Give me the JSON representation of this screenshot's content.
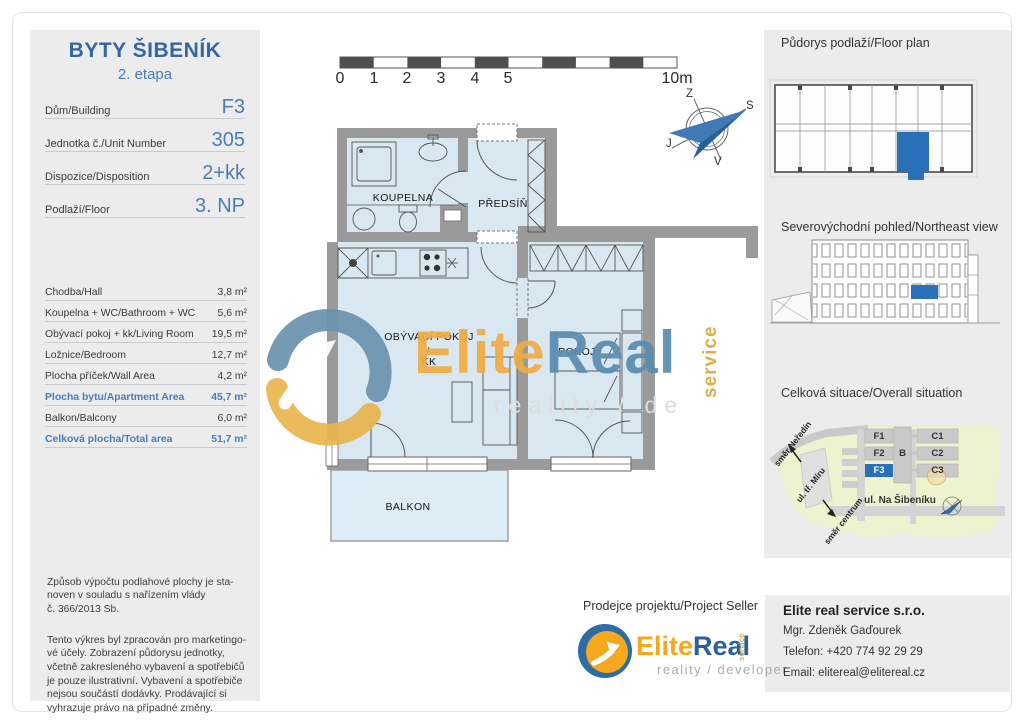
{
  "page": {
    "title": "BYTY ŠIBENÍK",
    "subtitle": "2. etapa"
  },
  "unit_fields": [
    {
      "label": "Dům/Building",
      "value": "F3"
    },
    {
      "label": "Jednotka č./Unit Number",
      "value": "305"
    },
    {
      "label": "Dispozice/Disposition",
      "value": "2+kk"
    },
    {
      "label": "Podlaží/Floor",
      "value": "3. NP"
    }
  ],
  "areas": [
    {
      "label": "Chodba/Hall",
      "value": "3,8 m²"
    },
    {
      "label": "Koupelna + WC/Bathroom + WC",
      "value": "5,6 m²"
    },
    {
      "label": "Obývací pokoj + kk/Living Room",
      "value": "19,5 m²"
    },
    {
      "label": "Ložnice/Bedroom",
      "value": "12,7 m²"
    },
    {
      "label": "Plocha příček/Wall Area",
      "value": "4,2 m²"
    },
    {
      "label": "Plocha bytu/Apartment Area",
      "value": "45,7 m²"
    },
    {
      "label": "Balkon/Balcony",
      "value": "6,0 m²"
    },
    {
      "label": "Celková plocha/Total area",
      "value": "51,7 m²"
    }
  ],
  "disclaimer": {
    "p1": [
      "Způsob výpočtu podlahové plochy je sta-",
      "noven v souladu s nařízením vlády",
      "č. 366/2013 Sb."
    ],
    "p2": [
      "Tento výkres byl zpracován pro marketingo-",
      "vé účely. Zobrazení půdorysu jednotky,",
      "včetně zakresleného vybavení a spotřebičů",
      "je pouze ilustrativní. Vybavení a spotřebiče",
      "nejsou součástí dodávky. Prodávající si",
      "vyhrazuje právo na případné změny."
    ]
  },
  "scale_bar": {
    "ticks": [
      "0",
      "1",
      "2",
      "3",
      "4",
      "5"
    ],
    "end": "10m"
  },
  "compass": {
    "top": "Z",
    "right": "S",
    "left": "J",
    "bottom": "V"
  },
  "rooms": {
    "bathroom": "KOUPELNA",
    "hall": "PŘEDSÍŇ",
    "living_1": "OBÝVACÍ POKOJ",
    "living_2": "+",
    "living_3": "KK",
    "bedroom": "POKOJ",
    "balcony": "BALKON"
  },
  "watermark": {
    "name_1": "Elite",
    "name_2": "Real",
    "vertical": "service",
    "tagline": "reality / de"
  },
  "sidebar": {
    "section_1": "Půdorys podlaží/Floor plan",
    "section_2": "Severovýchodní pohled/Northeast view",
    "section_3": "Celková situace/Overall situation",
    "site": {
      "f1": "F1",
      "f2": "F2",
      "f3": "F3",
      "b": "B",
      "c1": "C1",
      "c2": "C2",
      "c3": "C3",
      "street": "ul. Na Šibeníku",
      "dir_up": "směr Neředín",
      "road": "ul. tř. Míru",
      "dir_down": "směr centrum"
    }
  },
  "seller": {
    "heading": "Prodejce projektu/Project Seller",
    "logo_1": "Elite",
    "logo_2": "Real",
    "logo_vertical": "service",
    "logo_tagline": "reality / developer",
    "company": "Elite real service s.r.o.",
    "person": "Mgr. Zdeněk Gaďourek",
    "phone": "Telefon: +420 774 92 29 29",
    "email": "Email: elitereal@elitereal.cz"
  },
  "colors": {
    "accent_blue": "#3565a4",
    "value_blue": "#4a7cb8",
    "unit_highlight": "#2a70b8",
    "wall_gray": "#9a9a9a",
    "room_fill": "#d9e7f1",
    "logo_orange": "#f5a81c",
    "logo_blue": "#2a6099",
    "panel_gray": "#ececec"
  }
}
